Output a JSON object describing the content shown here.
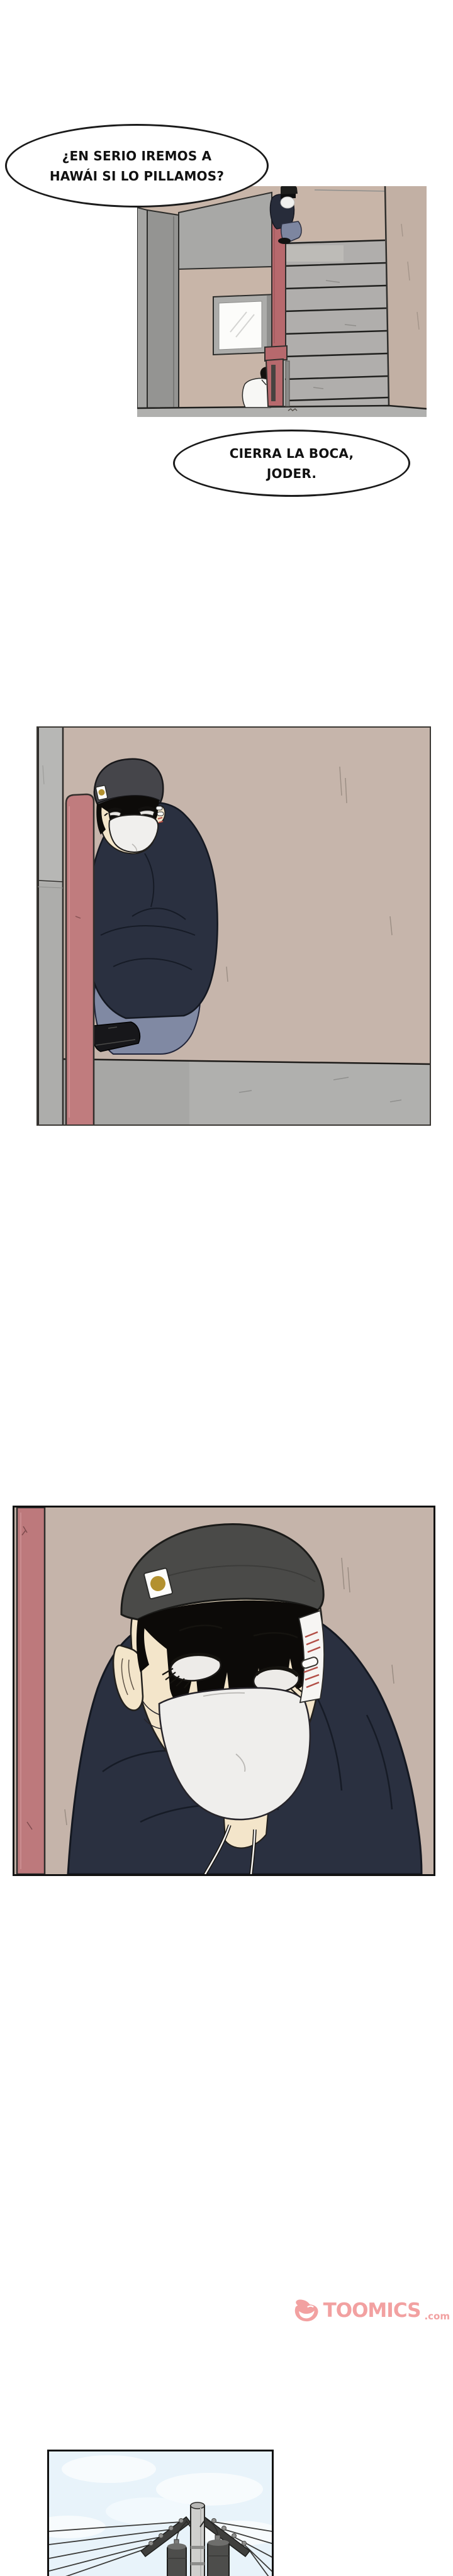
{
  "bubbles": {
    "b1": {
      "line1": "¿EN SERIO IREMOS A",
      "line2": "HAWÁI SI LO PILLAMOS?"
    },
    "b2": {
      "line1": "CIERRA LA BOCA,",
      "line2": "JODER."
    }
  },
  "watermark": {
    "brand": "TOOMICS",
    "suffix": ".com"
  },
  "colors": {
    "background": "#ffffff",
    "wall_beige": "#c8b5a8",
    "pipe_red": "#bd797c",
    "hoodie_navy": "#2a3040",
    "jeans_blue": "#8089a3",
    "mask_white": "#efeeec",
    "beanie_gray": "#4a4a48",
    "skin": "#f3e5ca",
    "floor_gray": "#b0b0ae",
    "stairs_gray": "#b0aeac",
    "sky_blue": "#e8f3fa",
    "watermark_pink": "#f2a1a1",
    "bubble_outline": "#1a1a1a"
  }
}
